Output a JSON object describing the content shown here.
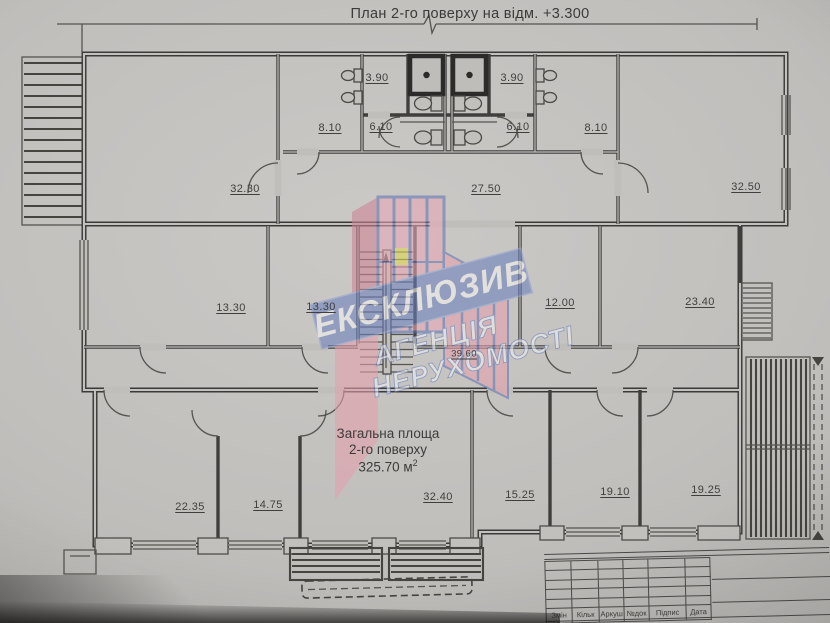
{
  "photo": {
    "paper_color": "#c1bfbc",
    "ink_color": "#3f3e3c"
  },
  "plan": {
    "title": "План 2-го поверху на відм. +3.300",
    "room_labels": [
      {
        "area": "3.90"
      },
      {
        "area": "3.90"
      },
      {
        "area": "8.10"
      },
      {
        "area": "6.10"
      },
      {
        "area": "6.10"
      },
      {
        "area": "8.10"
      },
      {
        "area": "32.30"
      },
      {
        "area": "27.50"
      },
      {
        "area": "32.50"
      },
      {
        "area": "13.30"
      },
      {
        "area": "13.30"
      },
      {
        "area": "12.00"
      },
      {
        "area": "23.40"
      },
      {
        "area": "39.60"
      },
      {
        "area": "22.35"
      },
      {
        "area": "14.75"
      },
      {
        "area": "32.40"
      },
      {
        "area": "15.25"
      },
      {
        "area": "19.10"
      },
      {
        "area": "19.25"
      }
    ],
    "total_area": {
      "line1": "Загальна площа",
      "line2": "2-го поверху",
      "value": "325.70 м",
      "sup": "2"
    }
  },
  "watermark": {
    "title": "ЕКСКЛЮЗИВ",
    "subtitle1": "АГЕНЦІЯ",
    "subtitle2": "НЕРУХОМОСТІ",
    "pink": "#e8a8b4",
    "deep_pink": "#cf8494",
    "blue": "#5d74b4",
    "banner_blue": "#6b80bd",
    "yellow": "#ddd84a"
  },
  "titleblock": {
    "labels": [
      "Змін",
      "Кільк",
      "Аркуш",
      "№док",
      "Підпис",
      "Дата"
    ]
  }
}
